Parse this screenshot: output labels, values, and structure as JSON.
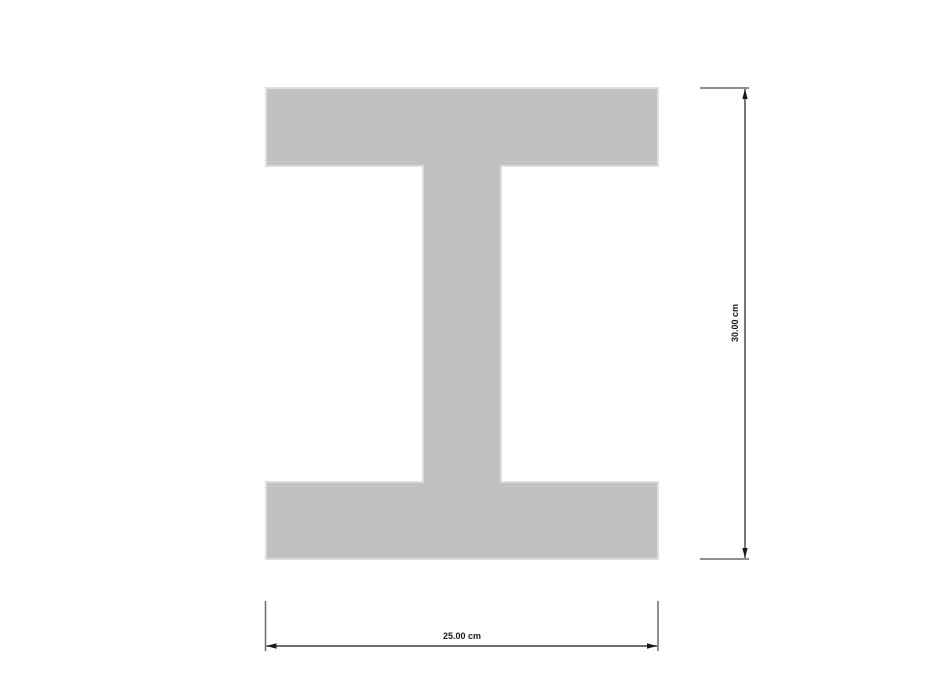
{
  "canvas": {
    "background_color": "#ffffff"
  },
  "section": {
    "shape_name": "I-section",
    "fill_color": "#c1c1c1",
    "outline_color": "#dddddd"
  },
  "dimensions": {
    "height": {
      "label": "30.00 cm",
      "value": 30.0,
      "unit": "cm"
    },
    "width": {
      "label": "25.00 cm",
      "value": 25.0,
      "unit": "cm"
    },
    "extension_line_color": "#6a6a6a",
    "dimension_line_color": "#3f3f3f",
    "arrow_color": "#1a1a1a",
    "label_color": "#1a1a1a"
  }
}
